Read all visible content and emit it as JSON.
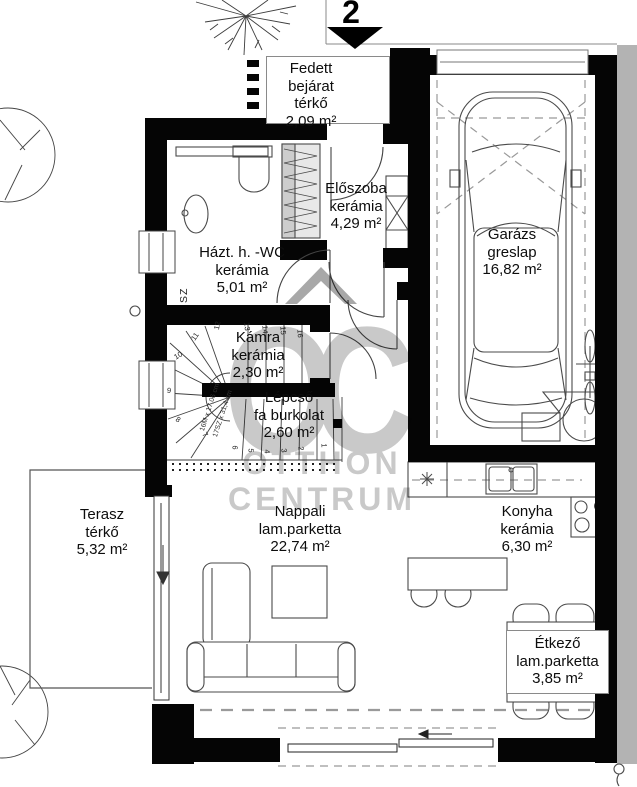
{
  "page": {
    "sheet_number": "2"
  },
  "watermark": {
    "logo": "OC",
    "line1": "OTTHON",
    "line2": "CENTRUM"
  },
  "rooms": {
    "fedett_bejarat": {
      "name": "Fedett bejárat",
      "floor": "térkő",
      "area": "2,09 m²"
    },
    "eloszoba": {
      "name": "Előszoba",
      "floor": "kerámia",
      "area": "4,29 m²"
    },
    "garazs": {
      "name": "Garázs",
      "floor": "greslap",
      "area": "16,82 m²"
    },
    "haztartasi_wc": {
      "name": "Házt. h. -WC",
      "floor": "kerámia",
      "area": "5,01 m²"
    },
    "kamra": {
      "name": "Kámra",
      "floor": "kerámia",
      "area": "2,30 m²"
    },
    "lepcso": {
      "name": "Lépcső",
      "floor": "fa burkolat",
      "area": "2,60 m²"
    },
    "terasz": {
      "name": "Terasz",
      "floor": "térkő",
      "area": "5,32 m²"
    },
    "nappali": {
      "name": "Nappali",
      "floor": "lam.parketta",
      "area": "22,74 m²"
    },
    "konyha": {
      "name": "Konyha",
      "floor": "kerámia",
      "area": "6,30 m²"
    },
    "etkezo": {
      "name": "Étkező",
      "floor": "lam.parketta",
      "area": "3,85 m²"
    }
  },
  "stairs": {
    "numbers": [
      "1",
      "2",
      "3",
      "4",
      "5",
      "6",
      "7",
      "8",
      "9",
      "10",
      "11",
      "12",
      "13",
      "14",
      "15",
      "16"
    ],
    "dimension_line1": "16M x 17,06 cm",
    "dimension_line2": "17SZ x 31,4 cm"
  },
  "annotations": {
    "sz_label": "SZ"
  },
  "colors": {
    "wall": "#050505",
    "watermark_gray": "#c9c9c9",
    "scan_strip": "#b3b3b3"
  }
}
